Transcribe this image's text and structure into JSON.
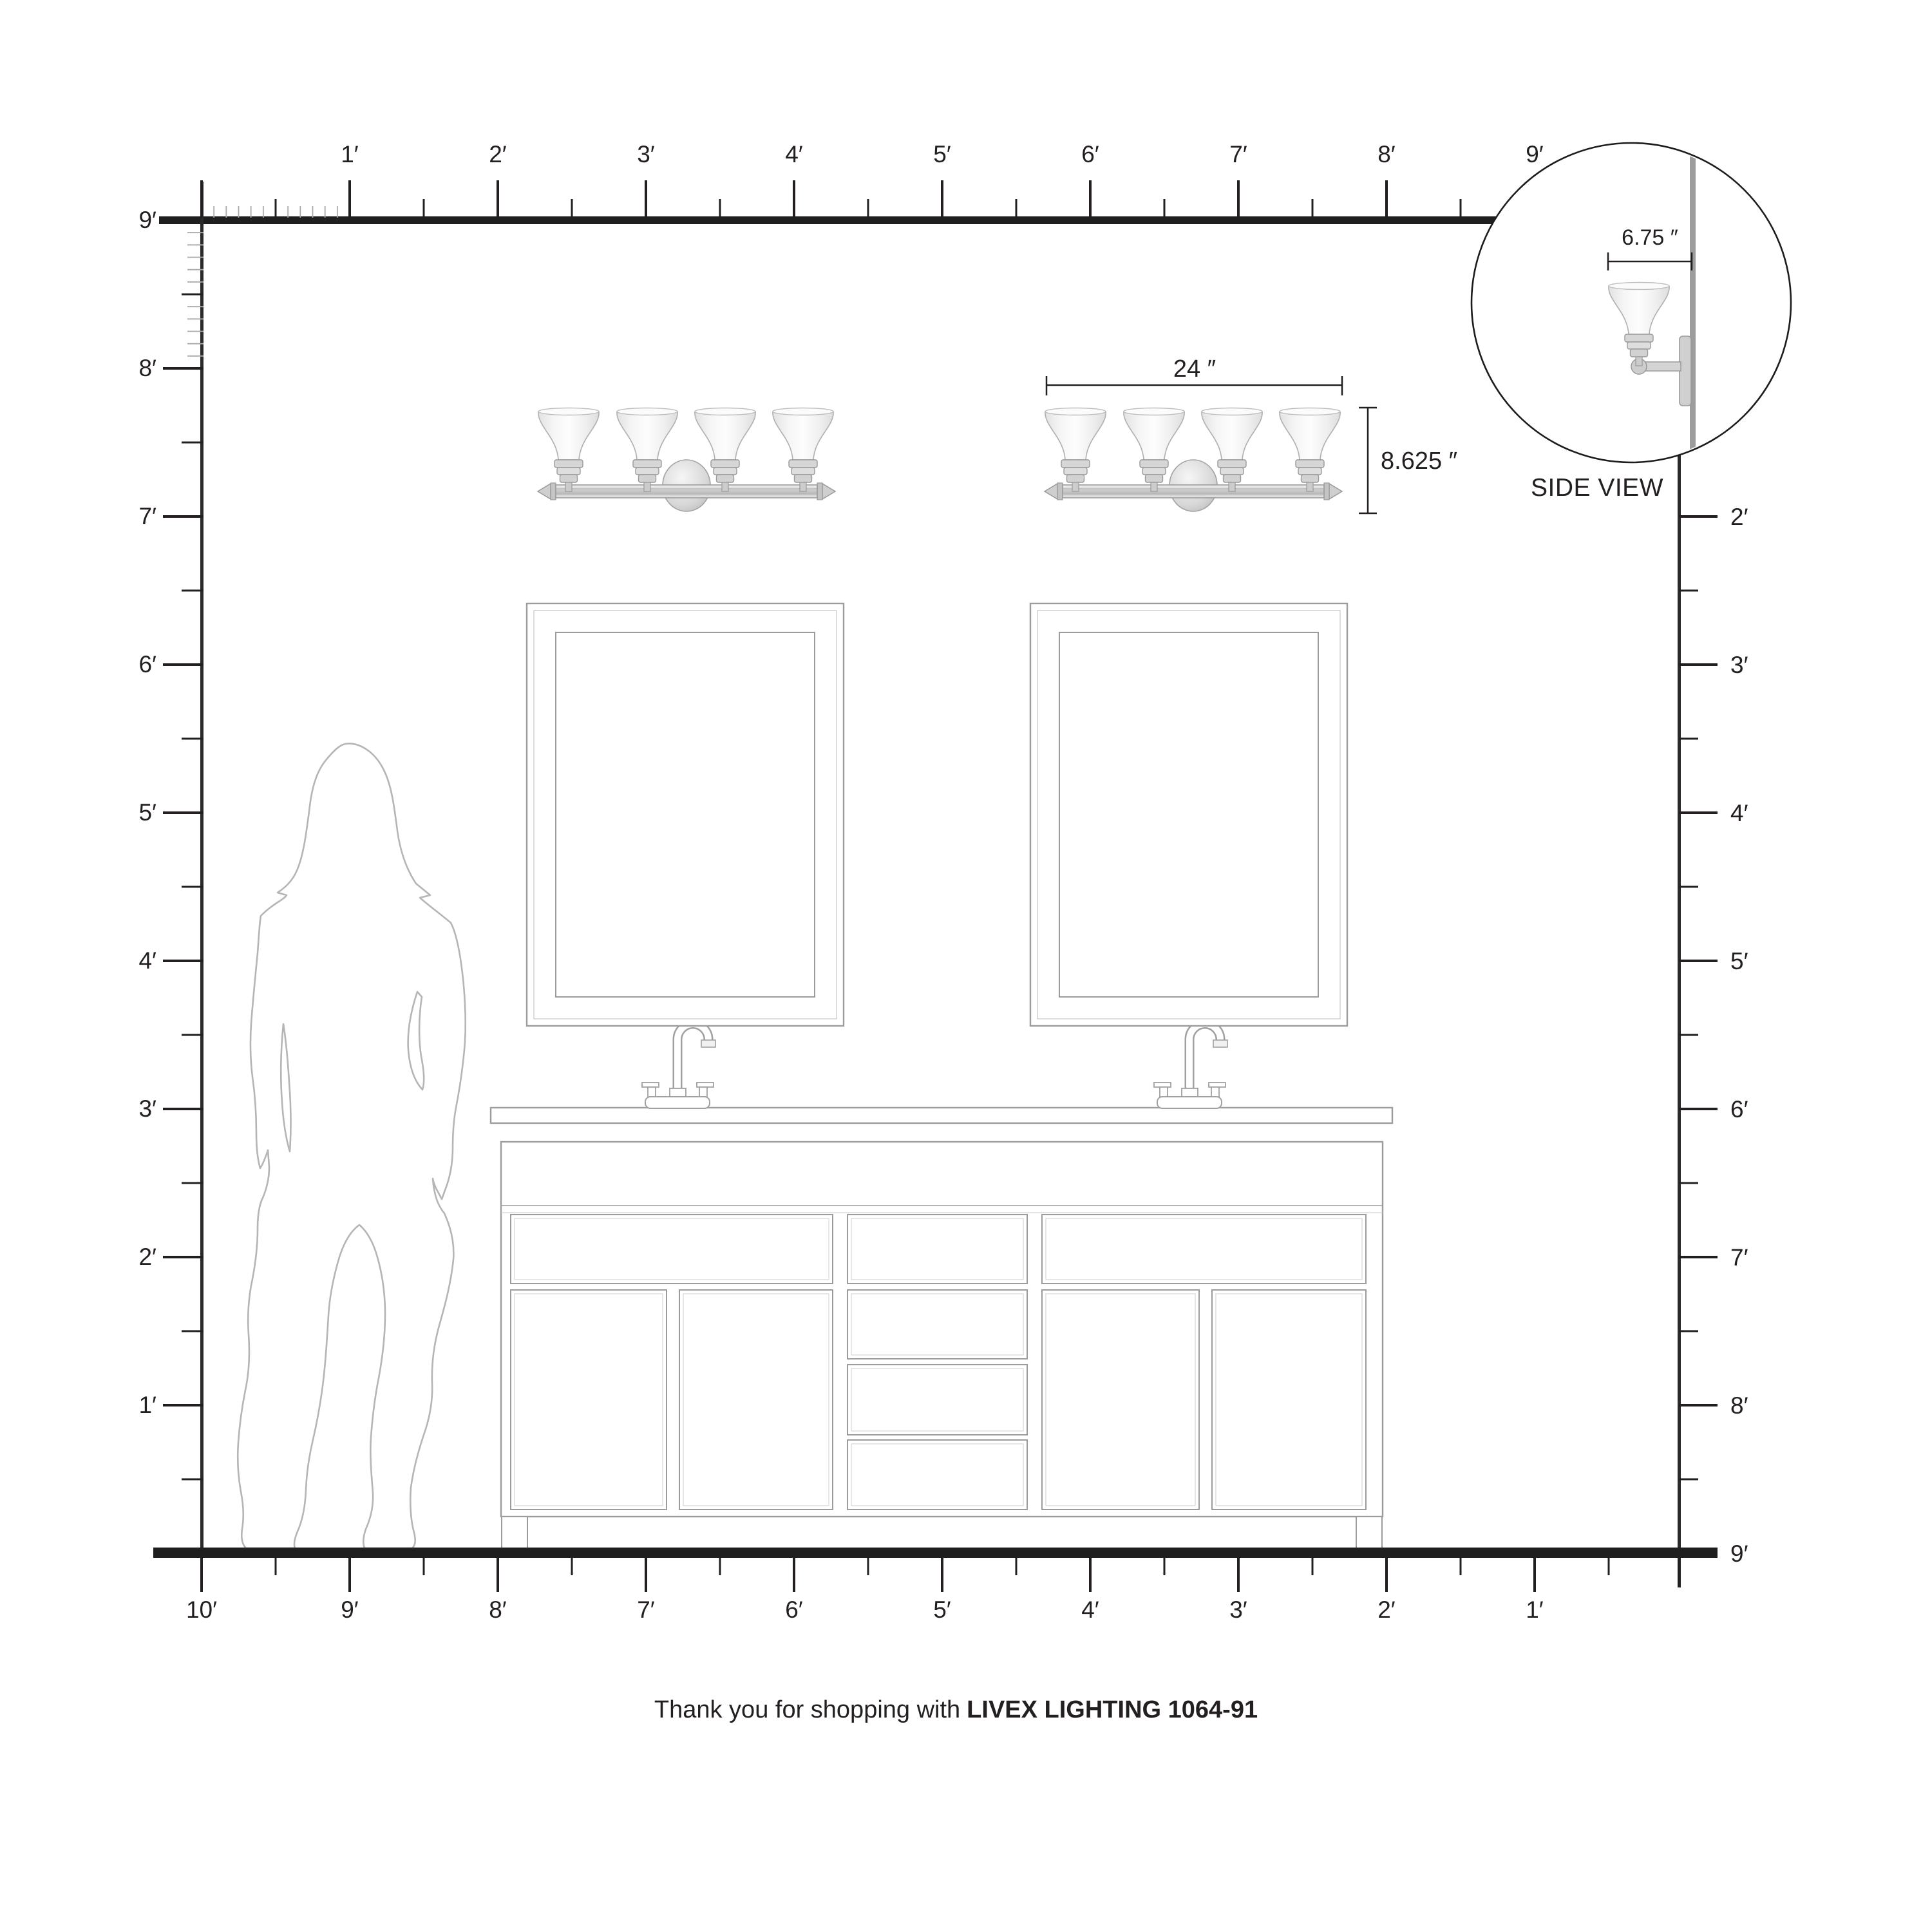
{
  "footer": {
    "prefix": "Thank you for shopping with",
    "brand": "LIVEX LIGHTING 1064-91"
  },
  "side_view": {
    "label": "SIDE VIEW",
    "depth_label": "6.75 ″"
  },
  "fixture_dimensions": {
    "width_label": "24 ″",
    "height_label": "8.625 ″"
  },
  "rulers": {
    "top": [
      "1′",
      "2′",
      "3′",
      "4′",
      "5′",
      "6′",
      "7′",
      "8′",
      "9′"
    ],
    "left": [
      "9′",
      "8′",
      "7′",
      "6′",
      "5′",
      "4′",
      "3′",
      "2′",
      "1′"
    ],
    "right": [
      "2′",
      "3′",
      "4′",
      "5′",
      "6′",
      "7′",
      "8′",
      "9′"
    ],
    "bottom": [
      "10′",
      "9′",
      "8′",
      "7′",
      "6′",
      "5′",
      "4′",
      "3′",
      "2′",
      "1′"
    ]
  },
  "colors": {
    "ink": "#231f20",
    "drawing_gray": "#9c9c9c",
    "silhouette_gray": "#b5b5b5",
    "inch_tick_gray": "#a9a9a9"
  }
}
